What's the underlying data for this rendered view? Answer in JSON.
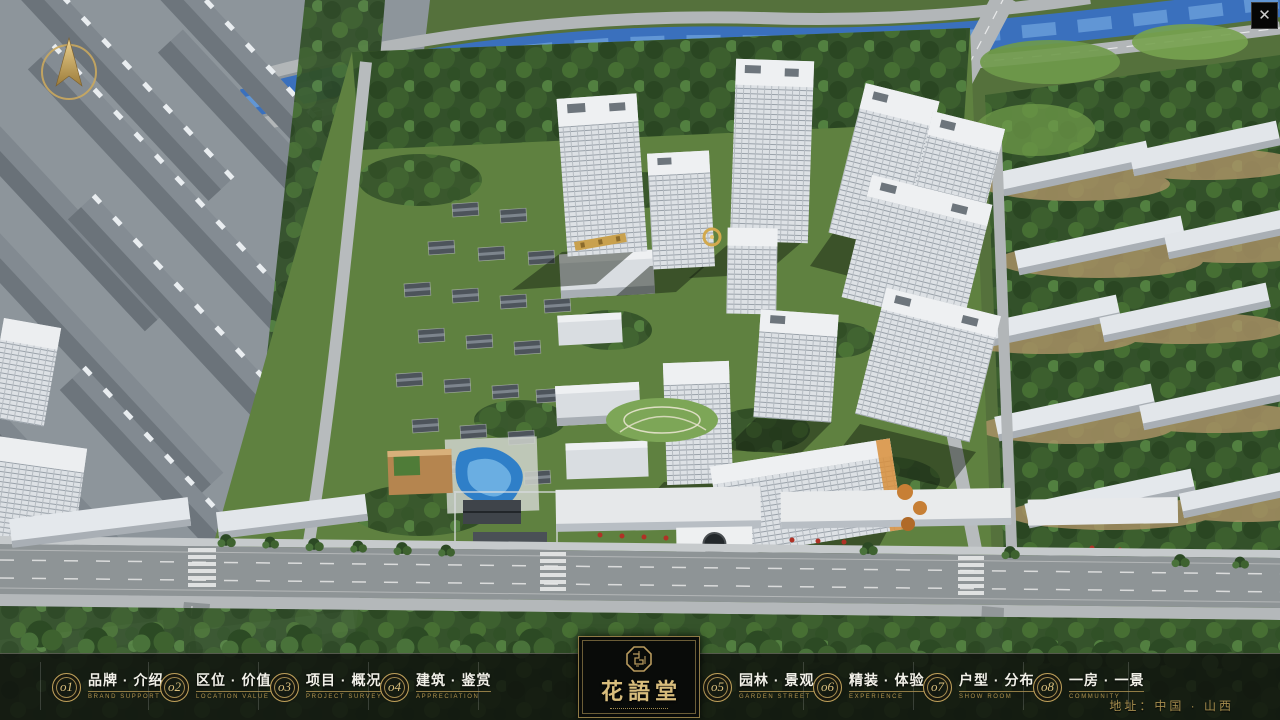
{
  "window": {
    "close_glyph": "✕"
  },
  "nav": {
    "items": [
      {
        "num": "o1",
        "label": "品牌 · 介绍",
        "sub": "BRAND SUPPORT"
      },
      {
        "num": "o2",
        "label": "区位 · 价值",
        "sub": "LOCATION VALUE"
      },
      {
        "num": "o3",
        "label": "项目 · 概况",
        "sub": "PROJECT SURVEY"
      },
      {
        "num": "o4",
        "label": "建筑 · 鉴赏",
        "sub": "APPRECIATION"
      },
      {
        "num": "o5",
        "label": "园林 · 景观",
        "sub": "GARDEN STREET"
      },
      {
        "num": "o6",
        "label": "精装 · 体验",
        "sub": "EXPERIENCE"
      },
      {
        "num": "o7",
        "label": "户型 · 分布",
        "sub": "SHOW ROOM"
      },
      {
        "num": "o8",
        "label": "一房 · 一景",
        "sub": "COMMUNITY"
      }
    ]
  },
  "logo": {
    "title": "花語堂"
  },
  "footer": {
    "address": "地址：中国 · 山西"
  },
  "colors": {
    "gold": "#c7a75f",
    "bar_bg": "rgba(13,16,12,0.82)",
    "river": "#3a70bd",
    "asphalt": "#8e9496"
  }
}
